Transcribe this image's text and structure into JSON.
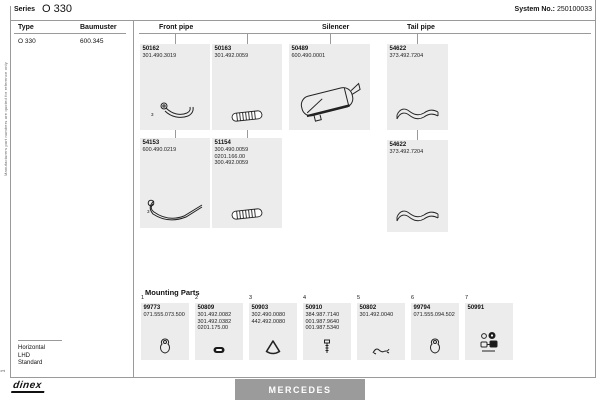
{
  "colors": {
    "box_bg": "#ececec",
    "line": "#9a9a9a",
    "brand_bar_bg": "#9b9b9b",
    "brand_text": "#ffffff"
  },
  "side_note": "Manufacturers part numbers are quoted for reference only",
  "page_marker": "1",
  "header": {
    "series_label": "Series",
    "series_value": "O 330",
    "system_label": "System No.:",
    "system_value": "250100033"
  },
  "vehicle": {
    "type_label": "Type",
    "type_value": "O 330",
    "baumuster_label": "Baumuster",
    "baumuster_value": "600.345",
    "config": [
      "Horizontal",
      "LHD",
      "Standard"
    ]
  },
  "columns": [
    {
      "label": "Front pipe"
    },
    {
      "label": "Silencer"
    },
    {
      "label": "Tail pipe"
    }
  ],
  "parts": [
    {
      "id": "50162",
      "refs": [
        "301.490.3019"
      ],
      "column": "Front pipe",
      "icon": "front-pipe-icon",
      "callout": "3"
    },
    {
      "id": "50163",
      "refs": [
        "301.492.0059"
      ],
      "column": "Front pipe",
      "icon": "flex-pipe-icon"
    },
    {
      "id": "50489",
      "refs": [
        "600.490.0001"
      ],
      "column": "Silencer",
      "icon": "silencer-icon"
    },
    {
      "id": "54622",
      "refs": [
        "373.492.7204"
      ],
      "column": "Tail pipe",
      "icon": "tail-pipe-icon"
    },
    {
      "id": "54153",
      "refs": [
        "600.490.0219"
      ],
      "column": "Front pipe",
      "icon": "long-pipe-icon",
      "callout": "3"
    },
    {
      "id": "51154",
      "refs": [
        "300.490.0059",
        "0201.166.00",
        "300.492.0059"
      ],
      "column": "Front pipe",
      "icon": "flex-pipe-icon"
    },
    {
      "id": "54622",
      "refs": [
        "373.492.7204"
      ],
      "column": "Tail pipe",
      "icon": "tail-pipe-icon"
    }
  ],
  "mounting": {
    "title": "Mounting Parts",
    "items": [
      {
        "index": "1",
        "id": "99773",
        "refs": [
          "071.555.073.500"
        ],
        "icon": "hanger-icon"
      },
      {
        "index": "2",
        "id": "50809",
        "refs": [
          "301.492.0082",
          "301.492.0382",
          "0201.175.00"
        ],
        "icon": "clamp-icon"
      },
      {
        "index": "3",
        "id": "50903",
        "refs": [
          "302.490.0080",
          "442.492.0080"
        ],
        "icon": "gasket-ring-icon"
      },
      {
        "index": "4",
        "id": "50910",
        "refs": [
          "384.987.7140",
          "001.987.9640",
          "001.987.5340"
        ],
        "icon": "bolt-icon"
      },
      {
        "index": "5",
        "id": "50802",
        "refs": [
          "301.492.0040"
        ],
        "icon": "u-clamp-icon"
      },
      {
        "index": "6",
        "id": "99794",
        "refs": [
          "071.555.094.502"
        ],
        "icon": "hanger-icon"
      },
      {
        "index": "7",
        "id": "50991",
        "refs": [],
        "icon": "fitting-kit-icon"
      }
    ]
  },
  "footer": {
    "brand": "MERCEDES",
    "logo": "dinex"
  }
}
